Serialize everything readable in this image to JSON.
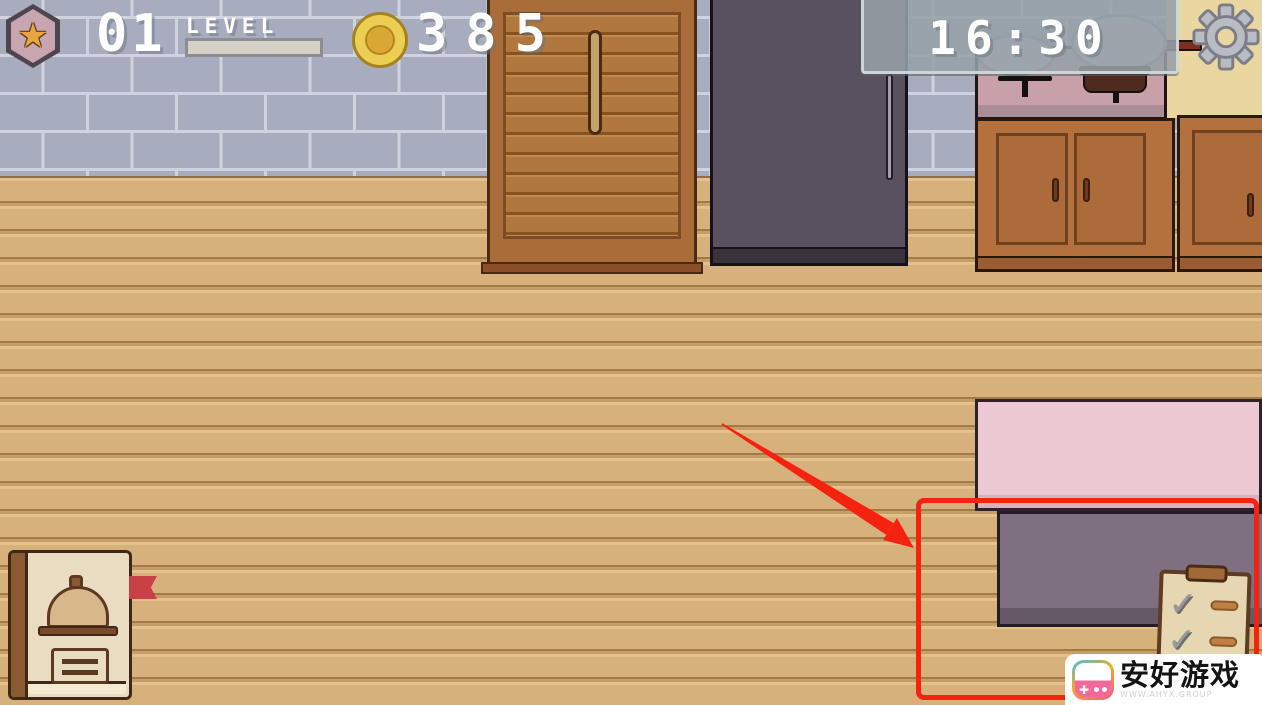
{
  "hud": {
    "level": {
      "value": "01",
      "label": "LEVEL",
      "progress_percent": 0,
      "badge_icon": "star-badge-icon"
    },
    "coins": {
      "count": "385",
      "icon": "coin-icon"
    },
    "timer": {
      "value": "16:30"
    },
    "settings": {
      "icon": "gear-icon"
    }
  },
  "scene": {
    "objects": [
      "brick-wall",
      "tan-wall",
      "wood-floor",
      "pantry-door",
      "refrigerator",
      "stove-with-pots",
      "lower-cabinet-double",
      "lower-cabinet-right",
      "pink-counter",
      "prep-table"
    ]
  },
  "tutorial": {
    "highlight": "red-rectangle-highlight",
    "arrow": "red-arrow",
    "clipboard": {
      "icon": "task-clipboard-icon",
      "rows": 2
    }
  },
  "recipe_book": {
    "icon": "recipe-book-icon"
  },
  "watermark": {
    "brand": "安好游戏",
    "url": "WWW.AHYX.GROUP",
    "logo_icon": "game-controller-icon"
  },
  "icons": {
    "star": "★",
    "check": "✓",
    "plus": "✚"
  },
  "colors": {
    "accent_red": "#f4220f",
    "floor_wood": "#d6b17b",
    "tan_wall": "#e9d6a0",
    "brick": "#a7acbe",
    "mortar": "#ced3df",
    "cabinet_brown": "#b5713d",
    "fridge_purple": "#59515f",
    "stove_pink": "#c7a0a8",
    "counter_pink": "#ecc9d2",
    "table_purple": "#7e7081",
    "coin_gold": "#ecce52",
    "hud_text": "#ffffff"
  }
}
